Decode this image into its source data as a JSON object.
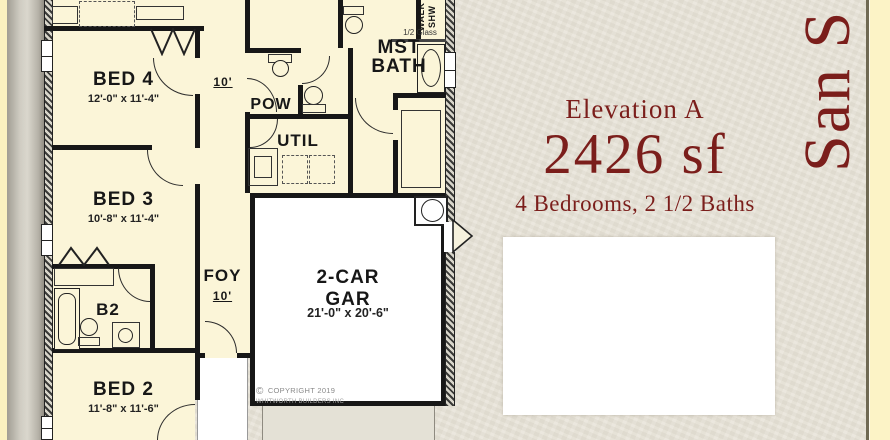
{
  "colors": {
    "accent_red": "#7b1e1b",
    "room_fill": "#fbf5d8",
    "wall": "#171717",
    "page_bg": "#e9e5da",
    "edge_strip": "#fbf2c2"
  },
  "plan": {
    "hall_label": "10'",
    "rooms": {
      "bed4": {
        "name": "BED 4",
        "dims": "12'-0\" x 11'-4\""
      },
      "bed3": {
        "name": "BED 3",
        "dims": "10'-8\" x 11'-4\""
      },
      "bed2": {
        "name": "BED 2",
        "dims": "11'-8\" x 11'-6\""
      },
      "b2": {
        "name": "B2"
      },
      "pow": {
        "name": "POW"
      },
      "util": {
        "name": "UTIL"
      },
      "foy": {
        "name": "FOY",
        "dims": "10'"
      },
      "mst_bath": {
        "name_line1": "MST",
        "name_line2": "BATH"
      },
      "walk_shower": {
        "name_line1": "WALK",
        "name_line2": "SHW"
      },
      "half_glass": {
        "label": "1/2 Glass"
      },
      "garage": {
        "name_line1": "2-CAR",
        "name_line2": "GAR",
        "dims": "21'-0\" x 20'-6\""
      }
    },
    "copyright": {
      "symbol": "©",
      "line1": "COPYRIGHT 2019",
      "line2": "WHITWORTH BUILDERS INC"
    }
  },
  "info_panel": {
    "elevation": "Elevation A",
    "area": "2426 sf",
    "beds_baths": "4 Bedrooms, 2 1/2 Baths",
    "plan_name_vertical": "San S"
  }
}
